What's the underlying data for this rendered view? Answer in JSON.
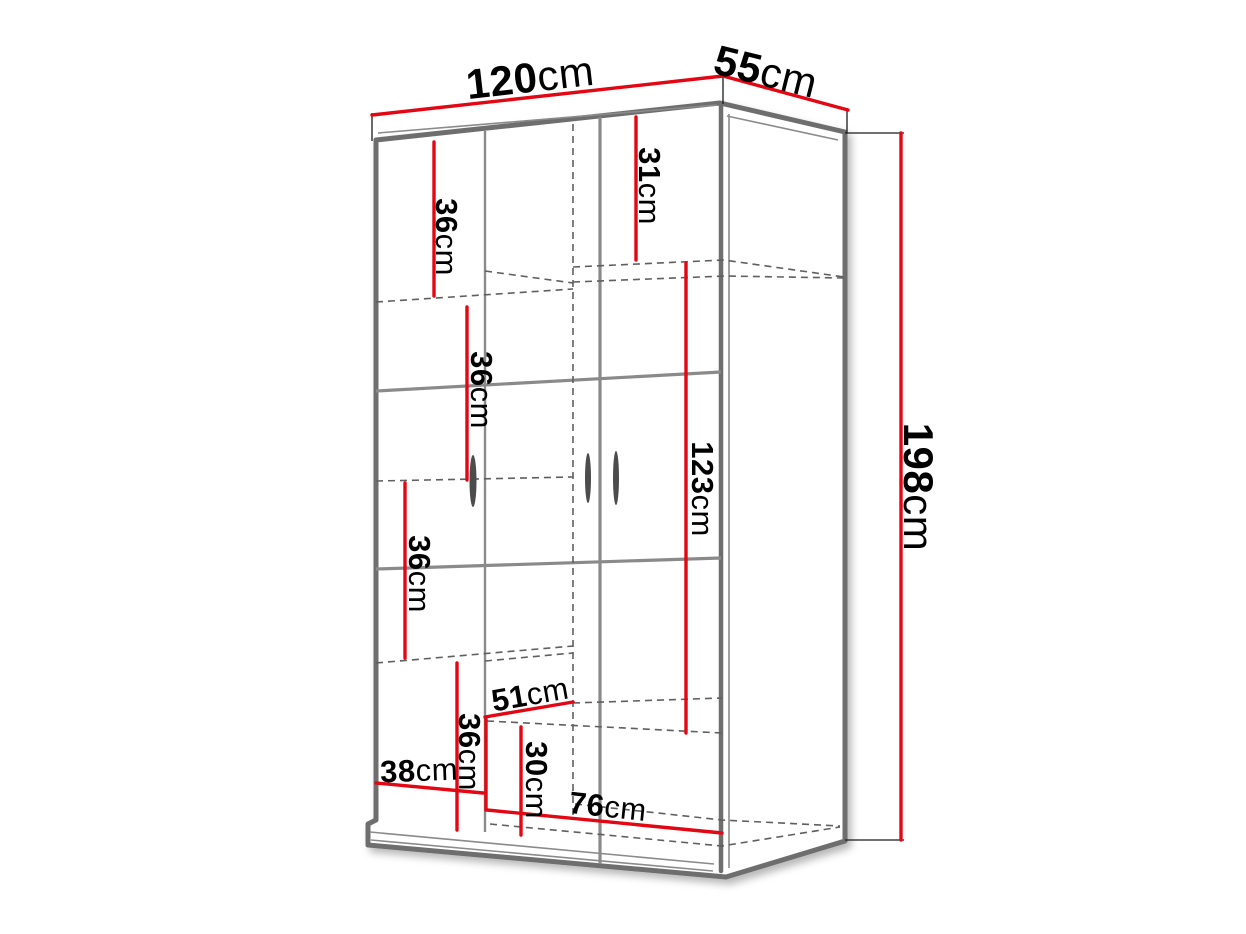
{
  "diagram": {
    "kind": "furniture-dimension-drawing",
    "subject": "wardrobe",
    "colors": {
      "red": "#e30613",
      "gray_dark": "#6e6e6e",
      "gray_mid": "#8a8a8a",
      "gray_dash": "#5f5f5f",
      "text": "#000000",
      "background": "#ffffff"
    },
    "dimensions": [
      {
        "id": "width-top",
        "value": "120",
        "unit": "cm",
        "x": 530,
        "y": 77,
        "rot": -6.5,
        "major": true
      },
      {
        "id": "depth-top",
        "value": "55",
        "unit": "cm",
        "x": 766,
        "y": 71,
        "rot": 14,
        "major": true
      },
      {
        "id": "height-right",
        "value": "198",
        "unit": "cm",
        "x": 919,
        "y": 487,
        "rot": 90,
        "major": true
      },
      {
        "id": "top-shelf-left",
        "value": "36",
        "unit": "cm",
        "x": 447,
        "y": 237,
        "rot": 90,
        "major": false
      },
      {
        "id": "top-shelf-right",
        "value": "31",
        "unit": "cm",
        "x": 650,
        "y": 186,
        "rot": 90,
        "major": false
      },
      {
        "id": "shelf-second",
        "value": "36",
        "unit": "cm",
        "x": 482,
        "y": 390,
        "rot": 90,
        "major": false
      },
      {
        "id": "hanging-section",
        "value": "123",
        "unit": "cm",
        "x": 703,
        "y": 489,
        "rot": 90,
        "major": false
      },
      {
        "id": "shelf-third",
        "value": "36",
        "unit": "cm",
        "x": 420,
        "y": 574,
        "rot": 90,
        "major": false
      },
      {
        "id": "interior-depth",
        "value": "51",
        "unit": "cm",
        "x": 530,
        "y": 694,
        "rot": -10,
        "major": false
      },
      {
        "id": "shelf-fourth",
        "value": "36",
        "unit": "cm",
        "x": 470,
        "y": 752,
        "rot": 90,
        "major": false
      },
      {
        "id": "left-section-width",
        "value": "38",
        "unit": "cm",
        "x": 419,
        "y": 770,
        "rot": -2,
        "major": false
      },
      {
        "id": "bottom-section",
        "value": "30",
        "unit": "cm",
        "x": 537,
        "y": 780,
        "rot": 90,
        "major": false
      },
      {
        "id": "right-section-width",
        "value": "76",
        "unit": "cm",
        "x": 608,
        "y": 806,
        "rot": 6,
        "major": false
      }
    ]
  }
}
